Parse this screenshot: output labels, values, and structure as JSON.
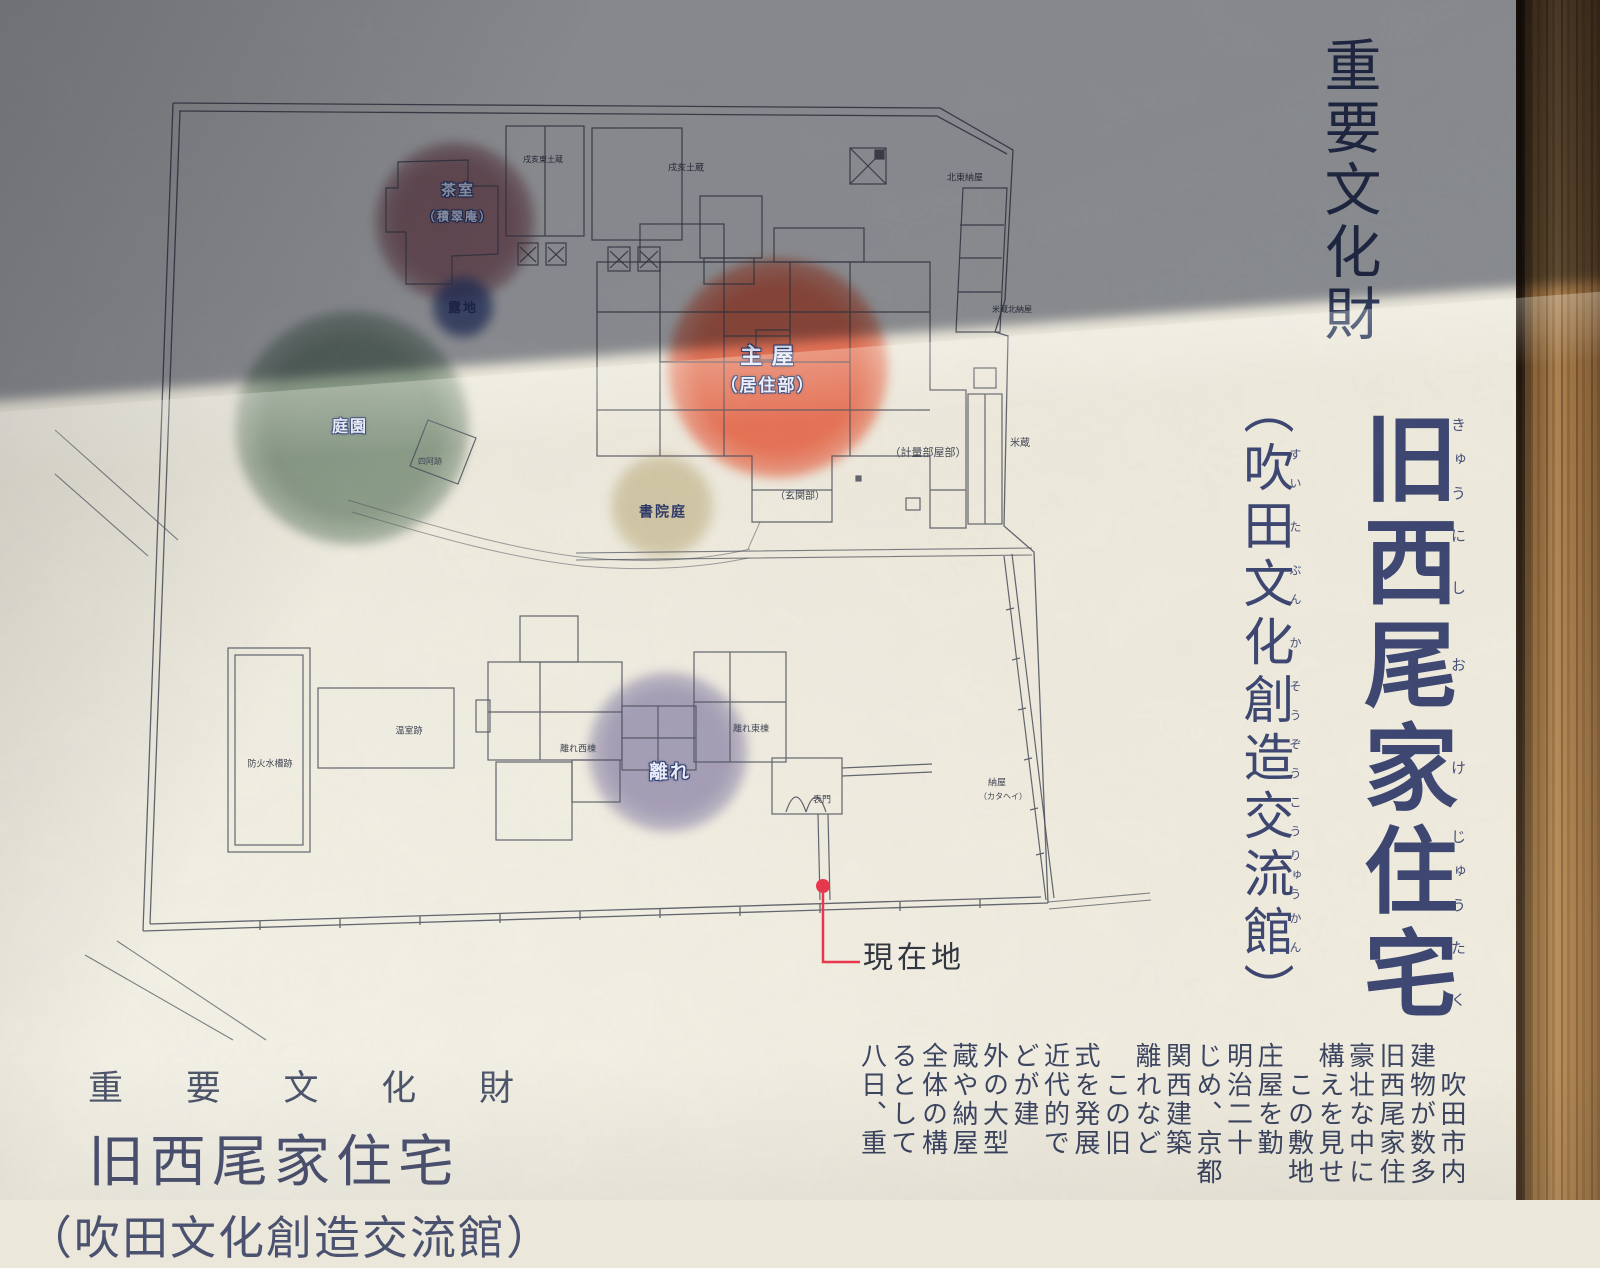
{
  "sign": {
    "header_vertical": "重要文化財",
    "title": {
      "chars": [
        {
          "k": "旧",
          "f": "きゅう"
        },
        {
          "k": "西",
          "f": "にし"
        },
        {
          "k": "尾",
          "f": "お"
        },
        {
          "k": "家",
          "f": "け"
        },
        {
          "k": "住",
          "f": "じゅう"
        },
        {
          "k": "宅",
          "f": "たく"
        }
      ]
    },
    "subtitle": {
      "open": "（",
      "close": "）",
      "chars": [
        {
          "k": "吹",
          "f": "すい"
        },
        {
          "k": "田",
          "f": "た"
        },
        {
          "k": "文",
          "f": "ぶん"
        },
        {
          "k": "化",
          "f": "か"
        },
        {
          "k": "創",
          "f": "そう"
        },
        {
          "k": "造",
          "f": "ぞう"
        },
        {
          "k": "交",
          "f": "こう"
        },
        {
          "k": "流",
          "f": "りゅう"
        },
        {
          "k": "館",
          "f": "かん"
        }
      ]
    },
    "body_columns": [
      "吹田市内",
      "建物が数多",
      "旧西尾家住",
      "豪壮な中に",
      "構えを見せ",
      "この敷地",
      "庄屋を勤",
      "明治二十",
      "じめ、京都",
      "関西建築",
      "離れなど",
      "この旧",
      "式を発展",
      "近代的で",
      "どが建",
      "外の大型",
      "蔵や納屋",
      "全体の構",
      "るとして",
      "八日、重"
    ],
    "body_indent_cols": [
      0,
      5,
      11
    ],
    "footer": {
      "line1": "重 要 文 化 財",
      "line2": "旧西尾家住宅",
      "line3": "（吹田文化創造交流館）"
    }
  },
  "map": {
    "areas": [
      {
        "name": "tea-house-area",
        "cx": 455,
        "cy": 222,
        "r": 80,
        "color": "rgba(118,42,58,0.60)"
      },
      {
        "name": "roji-area",
        "cx": 463,
        "cy": 307,
        "r": 31,
        "color": "rgba(38,58,120,0.72)"
      },
      {
        "name": "garden-area",
        "cx": 352,
        "cy": 428,
        "r": 117,
        "color": "rgba(74,104,80,0.62)"
      },
      {
        "name": "main-house-area",
        "cx": 778,
        "cy": 368,
        "r": 110,
        "color": "rgba(226,84,52,0.82)"
      },
      {
        "name": "shoin-garden-area",
        "cx": 662,
        "cy": 506,
        "r": 52,
        "color": "rgba(182,166,115,0.55)"
      },
      {
        "name": "hanare-area",
        "cx": 668,
        "cy": 752,
        "r": 80,
        "color": "rgba(112,104,152,0.60)"
      }
    ],
    "labels": [
      {
        "text": "茶室",
        "x": 458,
        "y": 192,
        "fs": 15,
        "st": "outline"
      },
      {
        "text": "（積翠庵）",
        "x": 458,
        "y": 217,
        "fs": 12,
        "st": "outline"
      },
      {
        "text": "戌亥東土蔵",
        "x": 543,
        "y": 160,
        "fs": 8,
        "st": "plain"
      },
      {
        "text": "戌亥土蔵",
        "x": 686,
        "y": 168,
        "fs": 9,
        "st": "plain"
      },
      {
        "text": "北東納屋",
        "x": 965,
        "y": 178,
        "fs": 9,
        "st": "plain"
      },
      {
        "text": "米蔵北納屋",
        "x": 1012,
        "y": 310,
        "fs": 8,
        "st": "plain"
      },
      {
        "text": "主 屋",
        "x": 768,
        "y": 356,
        "fs": 22,
        "st": "outline"
      },
      {
        "text": "（居住部）",
        "x": 768,
        "y": 386,
        "fs": 17,
        "st": "outline"
      },
      {
        "text": "庭園",
        "x": 350,
        "y": 428,
        "fs": 16,
        "st": "outline"
      },
      {
        "text": "露地",
        "x": 463,
        "y": 308,
        "fs": 13,
        "st": "navy"
      },
      {
        "text": "四阿跡",
        "x": 430,
        "y": 462,
        "fs": 8,
        "st": "plain"
      },
      {
        "text": "書院庭",
        "x": 663,
        "y": 514,
        "fs": 14,
        "st": "navy"
      },
      {
        "text": "（計量部屋部）",
        "x": 928,
        "y": 454,
        "fs": 11,
        "st": "plain"
      },
      {
        "text": "（玄関部）",
        "x": 800,
        "y": 497,
        "fs": 10,
        "st": "plain"
      },
      {
        "text": "米蔵",
        "x": 1020,
        "y": 444,
        "fs": 10,
        "st": "plain"
      },
      {
        "text": "防火水槽跡",
        "x": 270,
        "y": 764,
        "fs": 9,
        "st": "plain"
      },
      {
        "text": "温室跡",
        "x": 409,
        "y": 731,
        "fs": 9,
        "st": "plain"
      },
      {
        "text": "離れ西棟",
        "x": 578,
        "y": 749,
        "fs": 9,
        "st": "plain"
      },
      {
        "text": "離れ東棟",
        "x": 751,
        "y": 729,
        "fs": 9,
        "st": "plain"
      },
      {
        "text": "離れ",
        "x": 670,
        "y": 773,
        "fs": 19,
        "st": "outline"
      },
      {
        "text": "表門",
        "x": 822,
        "y": 800,
        "fs": 9,
        "st": "plain"
      },
      {
        "text": "納屋",
        "x": 997,
        "y": 783,
        "fs": 9,
        "st": "plain"
      },
      {
        "text": "（カタヘイ）",
        "x": 1003,
        "y": 797,
        "fs": 8,
        "st": "plain"
      },
      {
        "text": "現在地",
        "x": 914,
        "y": 958,
        "fs": 30,
        "st": "marker"
      }
    ],
    "marker": {
      "label": "現在地",
      "color": "#e8334a"
    }
  },
  "colors": {
    "paper_lit": "#ebe7da",
    "shadow_tint": "#2f3a55",
    "map_ink": "#474b58",
    "title_ink": "#3a446f",
    "accent_red": "#e8334a",
    "wood_frame": "#966d40"
  }
}
